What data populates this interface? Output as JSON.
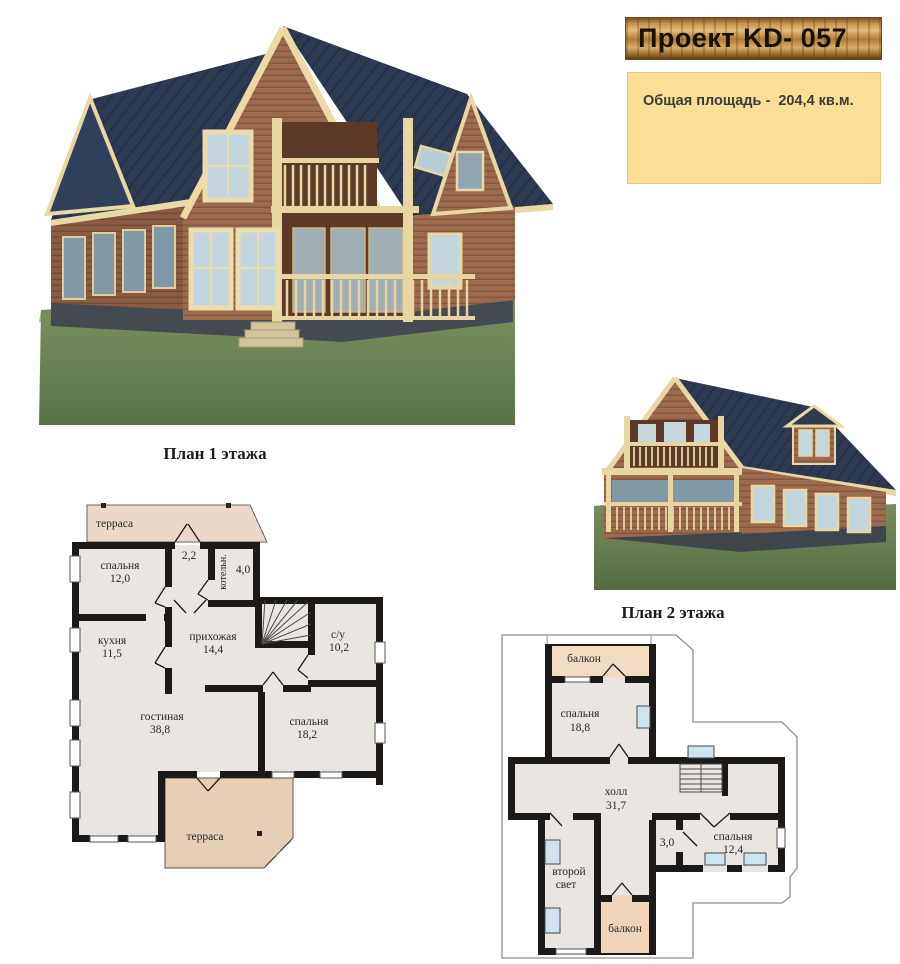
{
  "banner": {
    "title": "Проект KD- 057"
  },
  "info_box": {
    "text": "Общая площадь -  204,4 кв.м."
  },
  "colors": {
    "banner_wood": "#c59550",
    "info_bg": "#fcdf97",
    "wall": "#1c1a19",
    "floor": "#e9e5e1",
    "terrace_top": "#ebd8cb",
    "terrace_bottom": "#e7cfb5",
    "balcony": "#f1dcc3",
    "window_blue": "#cfe4ef",
    "roof_blue": "#2d3a52",
    "siding_brown": "#9c6b4e",
    "trim_cream": "#e9d7a4",
    "lawn_green": "#6f8a55"
  },
  "plan1": {
    "title": "План 1 этажа",
    "terrace_top": "терраса",
    "terrace_bottom": "терраса",
    "rooms": {
      "bedroom1": {
        "name": "спальня",
        "area": "12,0"
      },
      "hall_small": {
        "area": "2,2"
      },
      "boiler": {
        "name": "котельн.",
        "area": "4,0"
      },
      "kitchen": {
        "name": "кухня",
        "area": "11,5"
      },
      "entry": {
        "name": "прихожая",
        "area": "14,4"
      },
      "wc": {
        "name": "с/у",
        "area": "10,2"
      },
      "living": {
        "name": "гостиная",
        "area": "38,8"
      },
      "bedroom2": {
        "name": "спальня",
        "area": "18,2"
      }
    }
  },
  "plan2": {
    "title": "План 2 этажа",
    "balcony_top": "балкон",
    "balcony_bottom": "балкон",
    "rooms": {
      "bedroom3": {
        "name": "спальня",
        "area": "18,8"
      },
      "hall": {
        "name": "холл",
        "area": "31,7"
      },
      "closet": {
        "area": "3,0"
      },
      "bedroom4": {
        "name": "спальня",
        "area": "12,4"
      },
      "void": {
        "line1": "второй",
        "line2": "свет"
      }
    }
  }
}
